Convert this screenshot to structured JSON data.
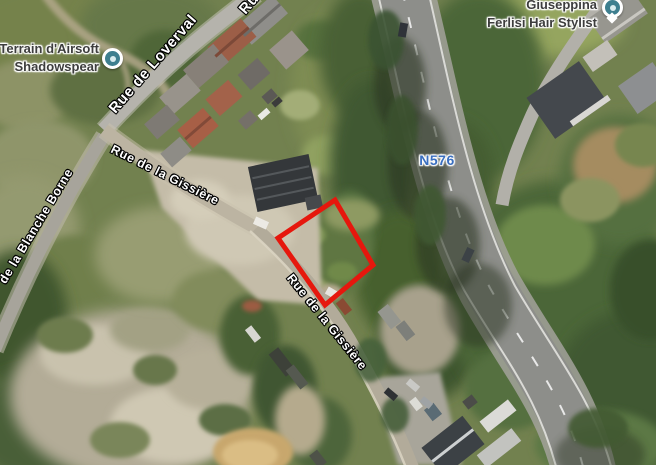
{
  "map": {
    "pois": [
      {
        "name": "terrain-airsoft",
        "lines": [
          "Terrain d'Airsoft",
          "Shadowspear"
        ],
        "icon": "poi-dot-icon",
        "icon_color": "#3e7f8f"
      },
      {
        "name": "giuseppina-hair-stylist",
        "lines": [
          "Giuseppina",
          "Ferlisi Hair Stylist"
        ],
        "icon": "map-pin-icon",
        "icon_color": "#3e7f8f"
      }
    ],
    "street_labels": [
      {
        "id": "loverval",
        "text": "Rue de Loverval"
      },
      {
        "id": "rue-cut",
        "text": "Ru"
      },
      {
        "id": "gissiere-1",
        "text": "Rue de la Gissière"
      },
      {
        "id": "gissiere-2",
        "text": "Rue de la Gissière"
      },
      {
        "id": "blanche",
        "text": "de la Blanche Borne"
      }
    ],
    "route_labels": [
      {
        "id": "n576",
        "text": "N576",
        "color": "#3a6fc0"
      }
    ],
    "parcel_outline": {
      "points": "335,200 373,265 325,305 278,238",
      "color": "#e6170d",
      "stroke_width": 5
    },
    "colors": {
      "parcel_red": "#e6170d",
      "route_label_blue": "#3a6fc0",
      "poi_icon_teal": "#3e7f8f",
      "street_label_white": "#ffffff",
      "poi_label_grey": "#3d3d3d",
      "woodland_green": "#4b6637",
      "road_asphalt": "#8d8e8a",
      "dirt_tan": "#c4bca8"
    }
  }
}
